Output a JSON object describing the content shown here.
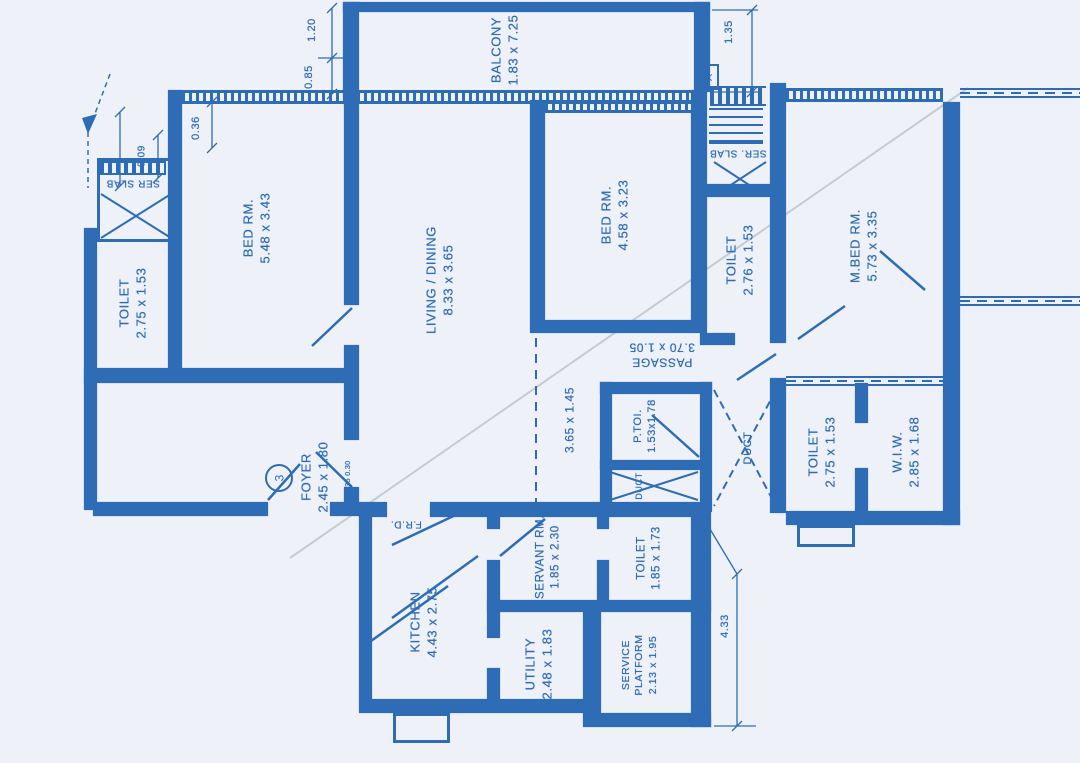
{
  "title": "Apartment unit floor plan",
  "colors": {
    "wall": "#2e6cb5",
    "text": "#2f6bb3",
    "paper": "#eef2f8",
    "crease": "#c6cad1"
  },
  "rooms": {
    "balcony": {
      "label": "BALCONY",
      "dims": "1.83 x 7.25"
    },
    "bed1": {
      "label": "BED RM.",
      "dims": "5.48 x 3.43"
    },
    "toilet1": {
      "label": "TOILET",
      "dims": "2.75 x 1.53"
    },
    "living": {
      "label": "LIVING / DINING",
      "dims": "8.33 x 3.65"
    },
    "bed2": {
      "label": "BED RM.",
      "dims": "4.58 x 3.23"
    },
    "toilet2": {
      "label": "TOILET",
      "dims": "2.76 x 1.53"
    },
    "master_bed": {
      "label": "M.BED RM.",
      "dims": "5.73 x 3.35"
    },
    "passage": {
      "label": "PASSAGE",
      "dims": "3.70 x 1.05"
    },
    "p_toi": {
      "label": "P.TOI.",
      "dims": "1.53x1.78"
    },
    "duct_main": {
      "label": "DUCT"
    },
    "duct_small": {
      "label": "DUCT"
    },
    "toilet3": {
      "label": "TOILET",
      "dims": "2.75 x 1.53"
    },
    "wiw": {
      "label": "W.I.W.",
      "dims": "2.85 x 1.68"
    },
    "foyer": {
      "label": "FOYER",
      "dims": "2.45 x 1.80"
    },
    "open_area": {
      "dims": "3.65 x 1.45"
    },
    "kitchen": {
      "label": "KITCHEN",
      "dims": "4.43 x 2.75"
    },
    "servant": {
      "label": "SERVANT RM.",
      "dims": "1.85 x 2.30"
    },
    "toilet4": {
      "label": "TOILET",
      "dims": "1.85 x 1.73"
    },
    "utility": {
      "label": "UTILITY",
      "dims": "2.48 x 1.83"
    },
    "service_platform": {
      "label": "SERVICE PLATFORM",
      "dims": "2.13 x 1.95"
    },
    "ser_slab_left": {
      "label": "SER SLAB"
    },
    "ser_slab_right": {
      "label": "SER. SLAB"
    }
  },
  "dimensions": {
    "balcony_side": "1.20",
    "balcony_offset": "0.85",
    "right_offset": "1.35",
    "wall_offset": "0.36",
    "slab_gap": "0.09",
    "lift_width": "4",
    "kitchen_side": "4.33",
    "door_note": "1.35 0.30"
  },
  "markers": {
    "entry_door": "3",
    "section_a": "A",
    "fire_door": "F.R.D."
  }
}
